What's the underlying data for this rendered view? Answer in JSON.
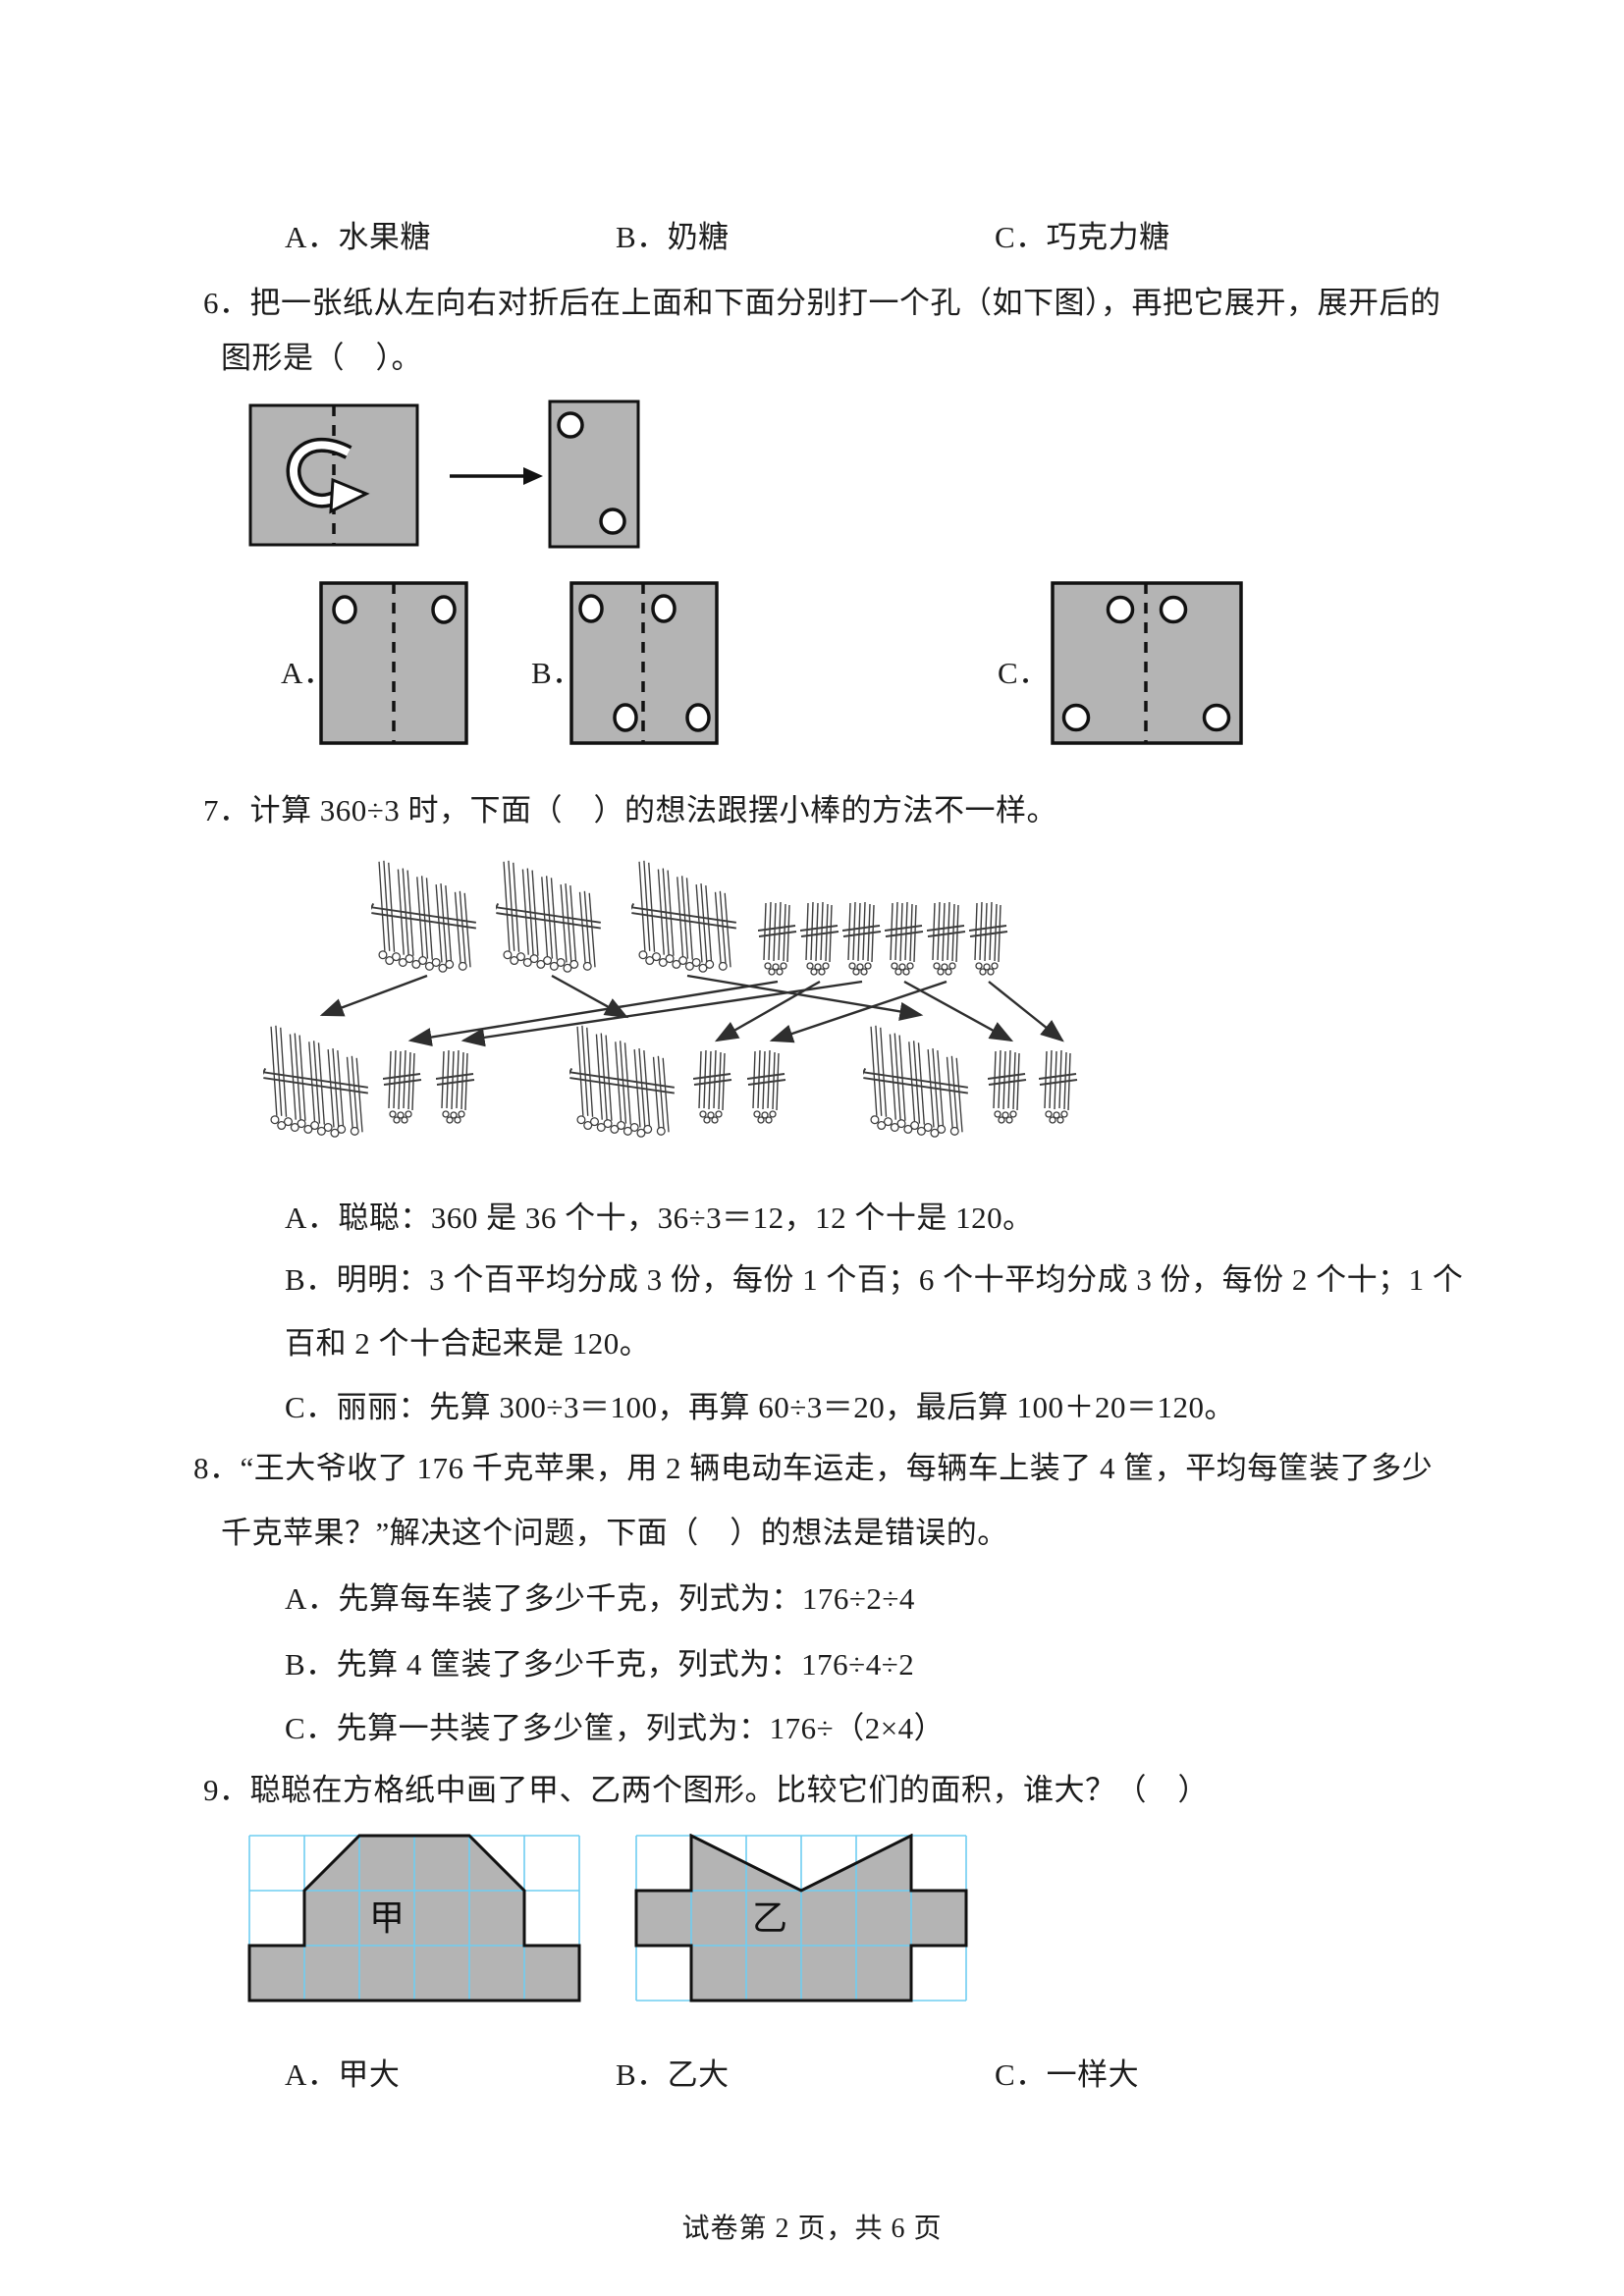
{
  "colors": {
    "shape_gray": "#b4b4b4",
    "grid_cyan": "#6fcdf1",
    "ink": "#1c1c1c"
  },
  "q5_options": {
    "a": "A．水果糖",
    "b": "B．奶糖",
    "c": "C．巧克力糖"
  },
  "q6": {
    "stem_line1": "6．把一张纸从左向右对折后在上面和下面分别打一个孔（如下图），再把它展开，展开后的",
    "stem_line2": "图形是（　）。",
    "labels": {
      "a": "A．",
      "b": "B．",
      "c": "C．"
    }
  },
  "q7": {
    "stem": "7．计算 360÷3 时，下面（　）的想法跟摆小棒的方法不一样。",
    "option_a": "A．聪聪：360 是 36 个十，36÷3＝12，12 个十是 120。",
    "option_b_line1": "B．明明：3 个百平均分成 3 份，每份 1 个百；6 个十平均分成 3 份，每份 2 个十；1 个",
    "option_b_line2": "百和 2 个十合起来是 120。",
    "option_c": "C．丽丽：先算 300÷3＝100，再算 60÷3＝20，最后算 100＋20＝120。"
  },
  "q8": {
    "stem_line1": "8．“王大爷收了 176 千克苹果，用 2 辆电动车运走，每辆车上装了 4 筐，平均每筐装了多少",
    "stem_line2": "千克苹果？”解决这个问题，下面（　）的想法是错误的。",
    "option_a": "A．先算每车装了多少千克，列式为：176÷2÷4",
    "option_b": "B．先算 4 筐装了多少千克，列式为：176÷4÷2",
    "option_c": "C．先算一共装了多少筐，列式为：176÷（2×4）"
  },
  "q9": {
    "stem": "9．聪聪在方格纸中画了甲、乙两个图形。比较它们的面积，谁大？（　）",
    "figure_labels": {
      "jia": "甲",
      "yi": "乙"
    },
    "option_a": "A．甲大",
    "option_b": "B．乙大",
    "option_c": "C．一样大"
  },
  "icons": {
    "fold_arrow": "curved-fold-arrow",
    "right_arrow": "right-arrow",
    "hole": "punched-hole",
    "big_bundle": "bundle-of-hundred-sticks",
    "small_bundle": "bundle-of-ten-sticks"
  },
  "footer": {
    "text": "试卷第 2 页，共 6 页"
  }
}
